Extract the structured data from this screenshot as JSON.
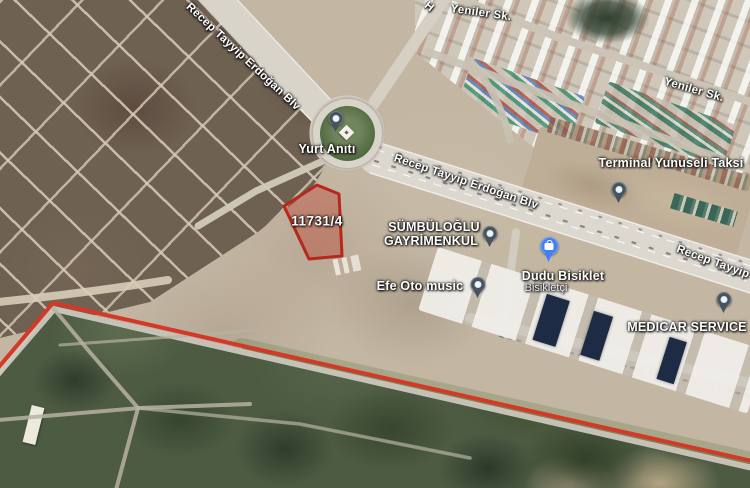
{
  "map": {
    "view": "satellite",
    "labels": [
      {
        "name": "road-label-rt-erdogan-blv-top",
        "text": "Recep Tayyip Erdoğan Blv",
        "x": 243,
        "y": 57,
        "rot": 43,
        "cls": "lbl-road",
        "interactable": false
      },
      {
        "name": "road-label-partial-h",
        "text": "H",
        "x": 429,
        "y": 7,
        "rot": 40,
        "cls": "lbl-road",
        "interactable": false
      },
      {
        "name": "road-label-yeniler-sk-top",
        "text": "Yeniler Sk.",
        "x": 481,
        "y": 13,
        "rot": 8,
        "cls": "lbl-road",
        "interactable": false
      },
      {
        "name": "road-label-yeniler-sk-right",
        "text": "Yeniler Sk.",
        "x": 694,
        "y": 90,
        "rot": 16,
        "cls": "lbl-road",
        "interactable": false
      },
      {
        "name": "poi-label-yurt-aniti",
        "text": "Yurt Anıtı",
        "x": 327,
        "y": 149,
        "rot": 0,
        "cls": "lbl-poi",
        "interactable": true
      },
      {
        "name": "road-label-rt-erdogan-blv-mid",
        "text": "Recep Tayyip Erdoğan Blv",
        "x": 466,
        "y": 182,
        "rot": 18.5,
        "cls": "lbl-road",
        "interactable": false
      },
      {
        "name": "poi-label-terminal-yunuseli-taksi",
        "text": "Terminal Yunuseli Taksi",
        "x": 671,
        "y": 163,
        "rot": 0,
        "cls": "lbl-poi",
        "interactable": true
      },
      {
        "name": "poi-label-sumbuloglu-line1",
        "text": "SÜMBÜLOĞLU",
        "x": 434,
        "y": 227,
        "rot": 0,
        "cls": "lbl-poi",
        "interactable": true
      },
      {
        "name": "poi-label-sumbuloglu-line2",
        "text": "GAYRİMENKUL",
        "x": 431,
        "y": 241,
        "rot": 0,
        "cls": "lbl-poi",
        "interactable": true
      },
      {
        "name": "poi-label-dudu-bisiklet",
        "text": "Dudu Bisiklet",
        "x": 563,
        "y": 276,
        "rot": 0,
        "cls": "lbl-poi",
        "interactable": true
      },
      {
        "name": "poi-label-dudu-bisiklet-sub",
        "text": "Bisikletçi",
        "x": 546,
        "y": 288,
        "rot": 0,
        "cls": "lbl-poi-sub",
        "interactable": true
      },
      {
        "name": "poi-label-efe-oto-music",
        "text": "Efe Oto music",
        "x": 420,
        "y": 286,
        "rot": 0,
        "cls": "lbl-poi",
        "interactable": true
      },
      {
        "name": "poi-label-medicar-service",
        "text": "MEDICAR SERVICE",
        "x": 687,
        "y": 327,
        "rot": 0,
        "cls": "lbl-poi",
        "interactable": true
      },
      {
        "name": "road-label-rt-erdogan-blv-right",
        "text": "Recep Tayyip",
        "x": 713,
        "y": 262,
        "rot": 20,
        "cls": "lbl-road",
        "interactable": false
      },
      {
        "name": "parcel-label",
        "text": "11731/4",
        "x": 317,
        "y": 221,
        "rot": 0,
        "cls": "lbl-parcel",
        "interactable": false
      }
    ],
    "pins": [
      {
        "name": "yurt-aniti-pin",
        "type": "poi",
        "x": 336,
        "y": 135
      },
      {
        "name": "terminal-yunuseli-taksi-pin",
        "type": "poi",
        "x": 619,
        "y": 206
      },
      {
        "name": "sumbuloglu-gayrimenkul-pin",
        "type": "poi",
        "x": 490,
        "y": 250
      },
      {
        "name": "dudu-bisiklet-pin",
        "type": "shop",
        "x": 549,
        "y": 264
      },
      {
        "name": "efe-oto-music-pin",
        "type": "poi",
        "x": 478,
        "y": 301
      },
      {
        "name": "medicar-service-pin",
        "type": "poi",
        "x": 724,
        "y": 316
      }
    ],
    "parcel": {
      "label": "11731/4",
      "points": "317,185 284,206 309,259 342,256 339,194",
      "stroke": "#b7281c",
      "fill": "rgba(190,60,45,0.38)"
    },
    "boundary": {
      "points": "-2,368 53,303 752,461",
      "stroke": "#d43826",
      "width": 4
    },
    "colors": {
      "poi_pin": "#47545f",
      "shop_pin": "#3f80f6",
      "road_fill": "#dcd8cf"
    }
  }
}
